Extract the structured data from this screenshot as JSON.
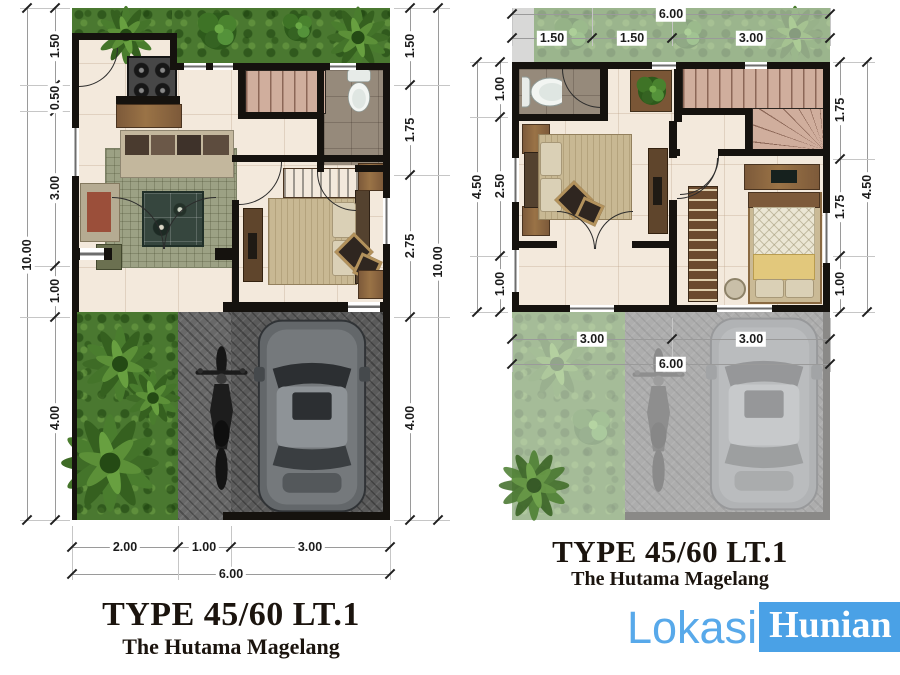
{
  "left_plan": {
    "title": "TYPE 45/60 LT.1",
    "subtitle": "The Hutama Magelang",
    "dims": {
      "left_outer": "10.00",
      "left_segments": [
        "1.50",
        "0.50",
        "3.00",
        "1.00",
        "4.00"
      ],
      "right_segments": [
        "1.50",
        "1.75",
        "2.75",
        "4.00"
      ],
      "right_outer": "10.00",
      "bottom_segments": [
        "2.00",
        "1.00",
        "3.00"
      ],
      "bottom_outer": "6.00"
    }
  },
  "right_plan": {
    "title": "TYPE 45/60 LT.1",
    "subtitle": "The Hutama Magelang",
    "dims": {
      "top_outer": "6.00",
      "top_segments": [
        "1.50",
        "1.50",
        "3.00"
      ],
      "left_outer": "4.50",
      "left_segments": [
        "1.00",
        "2.50",
        "1.00"
      ],
      "right_segments": [
        "1.75",
        "1.75",
        "1.00"
      ],
      "right_outer": "4.50",
      "bottom_segments": [
        "3.00",
        "3.00"
      ],
      "bottom_outer": "6.00"
    }
  },
  "logo": {
    "prefix": "Lokasi",
    "suffix": "Hunian",
    "prefix_color": "#58a9ea",
    "suffix_color": "#ffffff",
    "suffix_bg": "#4aa1e6"
  },
  "colors": {
    "wall": "#15120e",
    "floor_tile": "#f3e9dc",
    "bathroom_floor": "#968a7b",
    "grass": "#4a7830",
    "rug": "#9ca184",
    "stairs": "#d0ae9d",
    "paving": "#5a5a5a",
    "bed_cover": "#c8b893",
    "quilt": "#ebe6d4",
    "blanket_yellow": "#e2c87c",
    "wood": "#7d5a3a",
    "dim_text": "#1c1c1c"
  }
}
